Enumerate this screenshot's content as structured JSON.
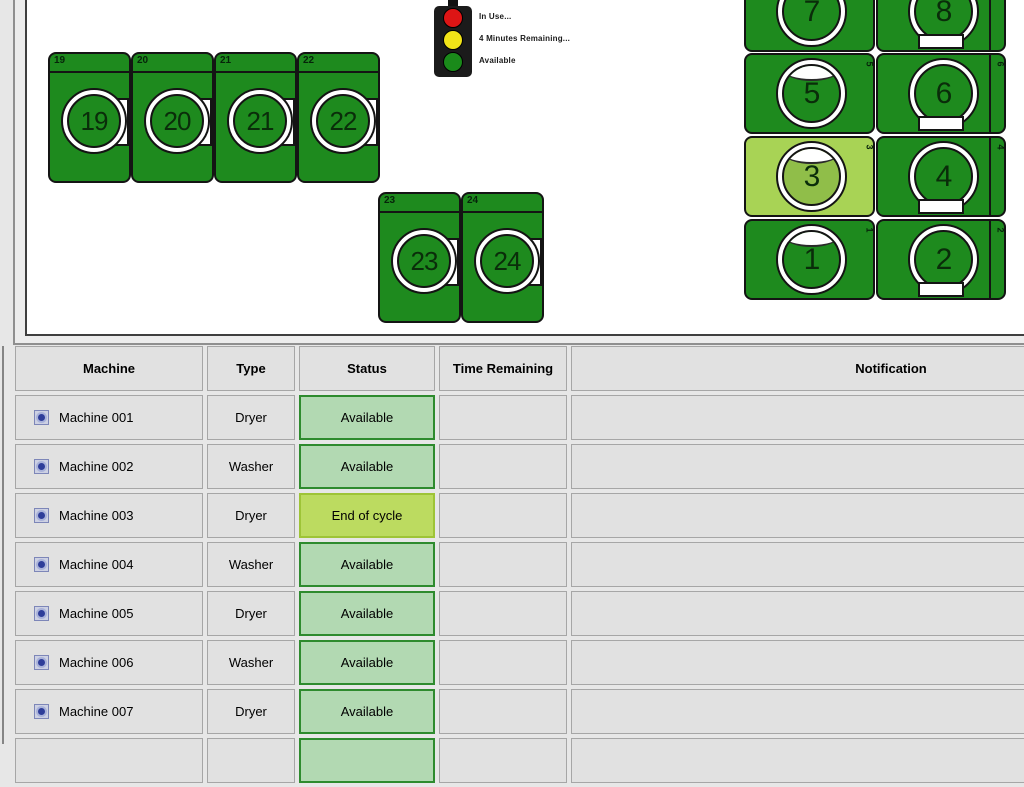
{
  "legend": {
    "items": [
      {
        "name": "in-use",
        "color": "#dd1515",
        "label": "In Use..."
      },
      {
        "name": "minutes-remaining",
        "color": "#f2e418",
        "label": "4 Minutes Remaining..."
      },
      {
        "name": "available",
        "color": "#1a8a1a",
        "label": "Available"
      }
    ]
  },
  "map": {
    "machines": [
      {
        "label": "19",
        "status": "available",
        "o": "v",
        "extra": "side-rect",
        "strip": false,
        "x": 48,
        "y": 52,
        "w": 83,
        "h": 131
      },
      {
        "label": "20",
        "status": "available",
        "o": "v",
        "extra": "side-rect",
        "strip": false,
        "x": 131,
        "y": 52,
        "w": 83,
        "h": 131
      },
      {
        "label": "21",
        "status": "available",
        "o": "v",
        "extra": "side-rect",
        "strip": false,
        "x": 214,
        "y": 52,
        "w": 83,
        "h": 131
      },
      {
        "label": "22",
        "status": "available",
        "o": "v",
        "extra": "side-rect",
        "strip": false,
        "x": 297,
        "y": 52,
        "w": 83,
        "h": 131
      },
      {
        "label": "23",
        "status": "available",
        "o": "v",
        "extra": "side-rect",
        "strip": false,
        "x": 378,
        "y": 192,
        "w": 83,
        "h": 131
      },
      {
        "label": "24",
        "status": "available",
        "o": "v",
        "extra": "side-rect",
        "strip": false,
        "x": 461,
        "y": 192,
        "w": 83,
        "h": 131
      },
      {
        "label": "7",
        "status": "available",
        "o": "h",
        "extra": "top-arc",
        "strip": false,
        "x": 744,
        "y": -29,
        "w": 131,
        "h": 81
      },
      {
        "label": "8",
        "status": "available",
        "o": "h",
        "extra": "bottom-rect",
        "strip": true,
        "x": 876,
        "y": -29,
        "w": 130,
        "h": 81
      },
      {
        "label": "5",
        "status": "available",
        "o": "h",
        "extra": "top-arc",
        "strip": false,
        "x": 744,
        "y": 53,
        "w": 131,
        "h": 81
      },
      {
        "label": "6",
        "status": "available",
        "o": "h",
        "extra": "bottom-rect",
        "strip": true,
        "x": 876,
        "y": 53,
        "w": 130,
        "h": 81
      },
      {
        "label": "3",
        "status": "end_of_cycle",
        "o": "h",
        "extra": "top-arc",
        "strip": false,
        "x": 744,
        "y": 136,
        "w": 131,
        "h": 81
      },
      {
        "label": "4",
        "status": "available",
        "o": "h",
        "extra": "bottom-rect",
        "strip": true,
        "x": 876,
        "y": 136,
        "w": 130,
        "h": 81
      },
      {
        "label": "1",
        "status": "available",
        "o": "h",
        "extra": "top-arc",
        "strip": false,
        "x": 744,
        "y": 219,
        "w": 131,
        "h": 81
      },
      {
        "label": "2",
        "status": "available",
        "o": "h",
        "extra": "bottom-rect",
        "strip": true,
        "x": 876,
        "y": 219,
        "w": 130,
        "h": 81
      }
    ]
  },
  "table": {
    "headers": [
      "Machine",
      "Type",
      "Status",
      "Time Remaining",
      "Notification"
    ],
    "rows": [
      {
        "machine": "Machine 001",
        "type": "Dryer",
        "status": "Available",
        "status_kind": "available",
        "time_remaining": "",
        "notification": ""
      },
      {
        "machine": "Machine 002",
        "type": "Washer",
        "status": "Available",
        "status_kind": "available",
        "time_remaining": "",
        "notification": ""
      },
      {
        "machine": "Machine 003",
        "type": "Dryer",
        "status": "End of cycle",
        "status_kind": "end_of_cycle",
        "time_remaining": "",
        "notification": ""
      },
      {
        "machine": "Machine 004",
        "type": "Washer",
        "status": "Available",
        "status_kind": "available",
        "time_remaining": "",
        "notification": ""
      },
      {
        "machine": "Machine 005",
        "type": "Dryer",
        "status": "Available",
        "status_kind": "available",
        "time_remaining": "",
        "notification": ""
      },
      {
        "machine": "Machine 006",
        "type": "Washer",
        "status": "Available",
        "status_kind": "available",
        "time_remaining": "",
        "notification": ""
      },
      {
        "machine": "Machine 007",
        "type": "Dryer",
        "status": "Available",
        "status_kind": "available",
        "time_remaining": "",
        "notification": ""
      },
      {
        "machine": "",
        "type": "",
        "status": "",
        "status_kind": "available",
        "time_remaining": "",
        "notification": ""
      }
    ]
  },
  "colors": {
    "machine_available": "#1e8a1e",
    "machine_end_of_cycle": "#a8d355",
    "status_available_bg": "#b2d9b2",
    "status_available_border": "#2e8b2e",
    "status_end_of_cycle_bg": "#bcdb60",
    "traffic_red": "#dd1515",
    "traffic_yellow": "#f2e418",
    "traffic_green": "#1a8a1a"
  }
}
